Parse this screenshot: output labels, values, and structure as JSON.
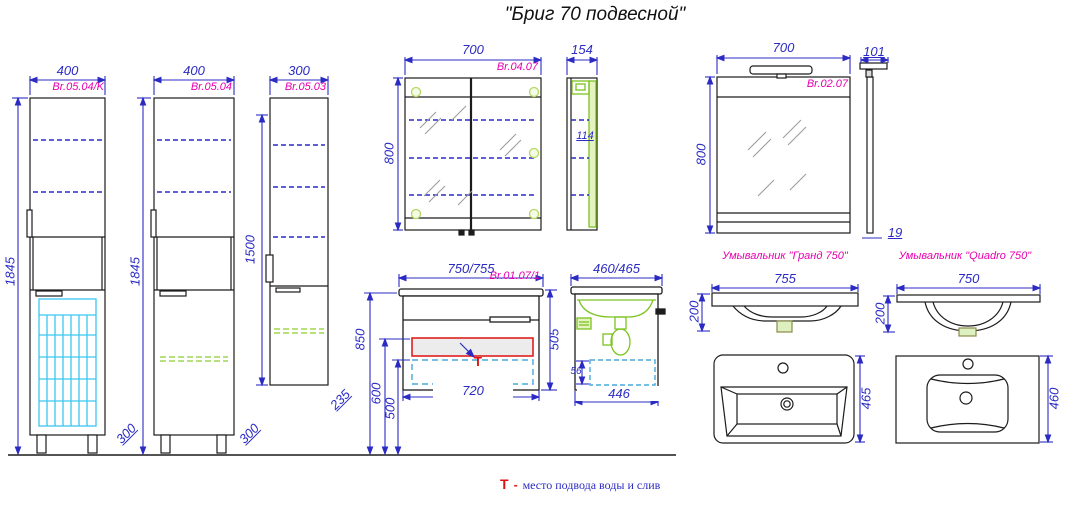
{
  "title": "\"Бриг 70 подвесной\"",
  "legend": {
    "symbol": "Т",
    "separator": "-",
    "text": "место подвода воды и слив"
  },
  "colors": {
    "dimension_blue": "#2b2bc4",
    "label_magenta": "#e800b0",
    "accent_green": "#7cc421",
    "basket_cyan": "#3cc6f0",
    "drawer_dash_blue": "#4aa8dc",
    "marker_red": "#dd1111",
    "line_black": "#1c1c1c"
  },
  "views": {
    "tall_cabinet_k": {
      "code": "Br.05.04/K",
      "width": "400",
      "height": "1845",
      "depth": "300"
    },
    "tall_cabinet": {
      "code": "Br.05.04",
      "width": "400",
      "height": "1845",
      "depth": "300"
    },
    "hanging_cabinet": {
      "code": "Br.05.03",
      "width": "300",
      "height": "1500",
      "depth": "235"
    },
    "mirror_cabinet": {
      "code": "Br.04.07",
      "width": "700",
      "height": "800",
      "side_depth": "154",
      "shelf_depth": "114"
    },
    "mirror": {
      "code": "Br.02.07",
      "width": "700",
      "height": "800",
      "lamp_depth": "101",
      "thickness": "19"
    },
    "vanity": {
      "code": "Br.01.07/1",
      "width": "750/755",
      "height": "505",
      "inner_width": "720",
      "mount_height": "850",
      "supply_height": "600",
      "drawer_height": "500",
      "tee": "Т"
    },
    "vanity_side": {
      "depth": "460/465",
      "bottom_depth": "446",
      "drawer_gap": "56"
    },
    "sink_grand": {
      "name": "Умывальник \"Гранд 750\"",
      "width": "755",
      "height": "200",
      "depth": "465"
    },
    "sink_quadro": {
      "name": "Умывальник \"Quadro 750\"",
      "width": "750",
      "height": "200",
      "depth": "460"
    }
  }
}
